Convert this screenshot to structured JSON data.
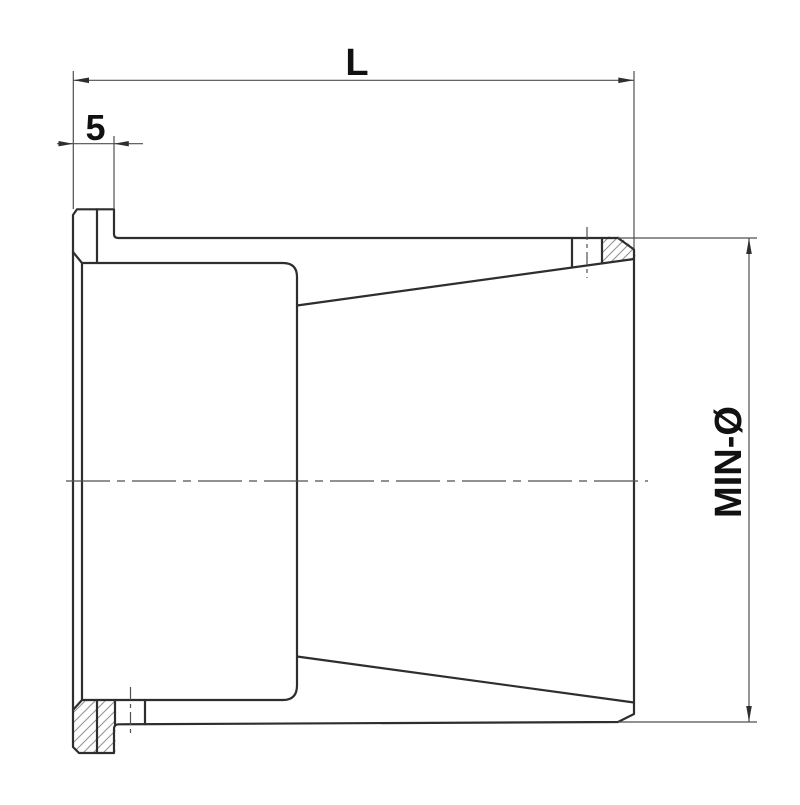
{
  "drawing": {
    "type": "technical-section-drawing",
    "subject": "flanged clamping sleeve with tapered bore, cross-section view",
    "dimensions": {
      "length": {
        "label": "L"
      },
      "flange_width": {
        "label": "5"
      },
      "min_diameter": {
        "label": "MIN-Ø"
      }
    }
  },
  "style": {
    "background": "#ffffff",
    "line_color": "#2e2e2e",
    "thin_line_color": "#4f4f4f",
    "hatch_color": "#949494",
    "text_color": "#111111"
  }
}
